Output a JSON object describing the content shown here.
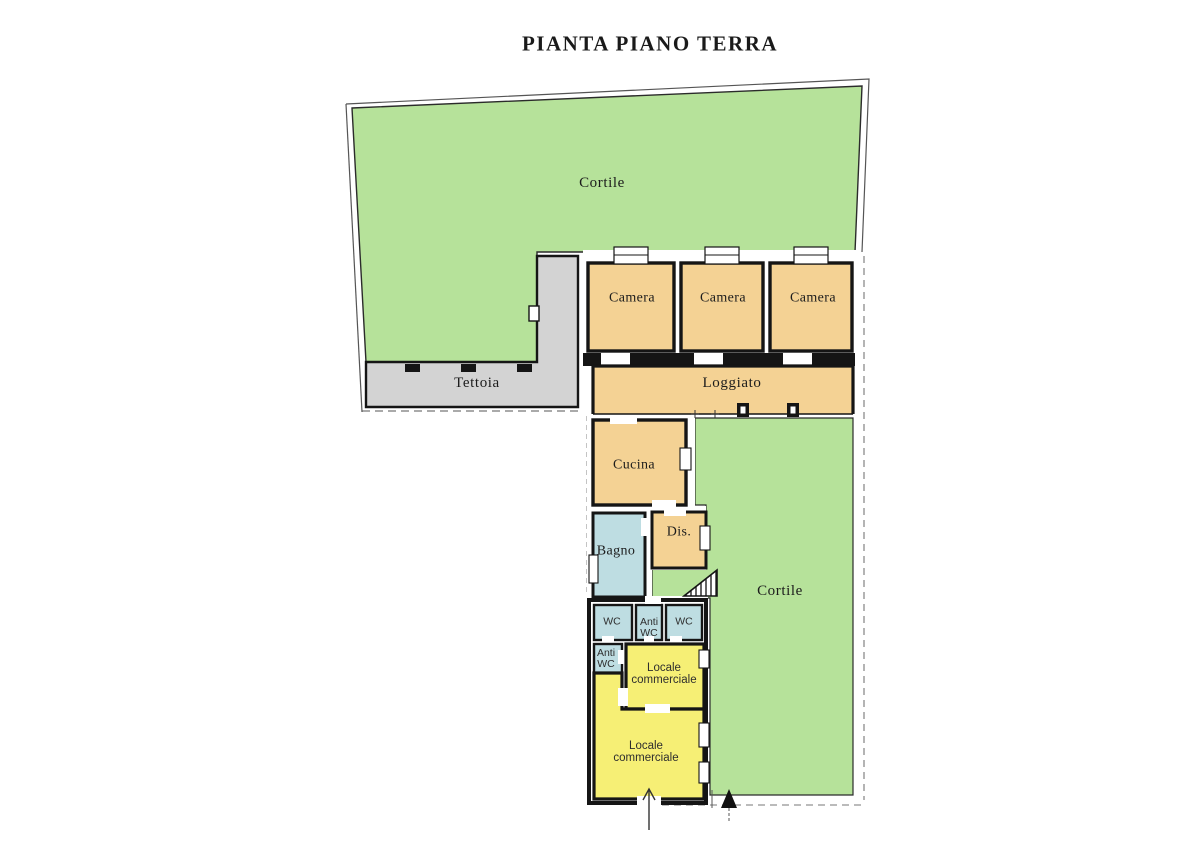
{
  "title": "PIANTA PIANO TERRA",
  "legend_colors": {
    "courtyard_green": "#b6e29a",
    "rooms_orange": "#f4d294",
    "canopy_gray": "#d3d3d3",
    "service_blue": "#bedde2",
    "commercial_yellow": "#f6ef75",
    "wall_black": "#151515"
  },
  "rooms": {
    "cortile_top": {
      "label": "Cortile"
    },
    "camera_1": {
      "label": "Camera"
    },
    "camera_2": {
      "label": "Camera"
    },
    "camera_3": {
      "label": "Camera"
    },
    "tettoia": {
      "label": "Tettoia"
    },
    "loggiato": {
      "label": "Loggiato"
    },
    "cucina": {
      "label": "Cucina"
    },
    "bagno": {
      "label": "Bagno"
    },
    "dis": {
      "label": "Dis."
    },
    "cortile_right": {
      "label": "Cortile"
    },
    "wc_1": {
      "label": "WC"
    },
    "anti_wc_1": {
      "label": "Anti WC"
    },
    "wc_2": {
      "label": "WC"
    },
    "anti_wc_2": {
      "label": "Anti WC"
    },
    "locale_commerciale_1": {
      "label": "Locale commerciale"
    },
    "locale_commerciale_2": {
      "label": "Locale commerciale"
    }
  }
}
